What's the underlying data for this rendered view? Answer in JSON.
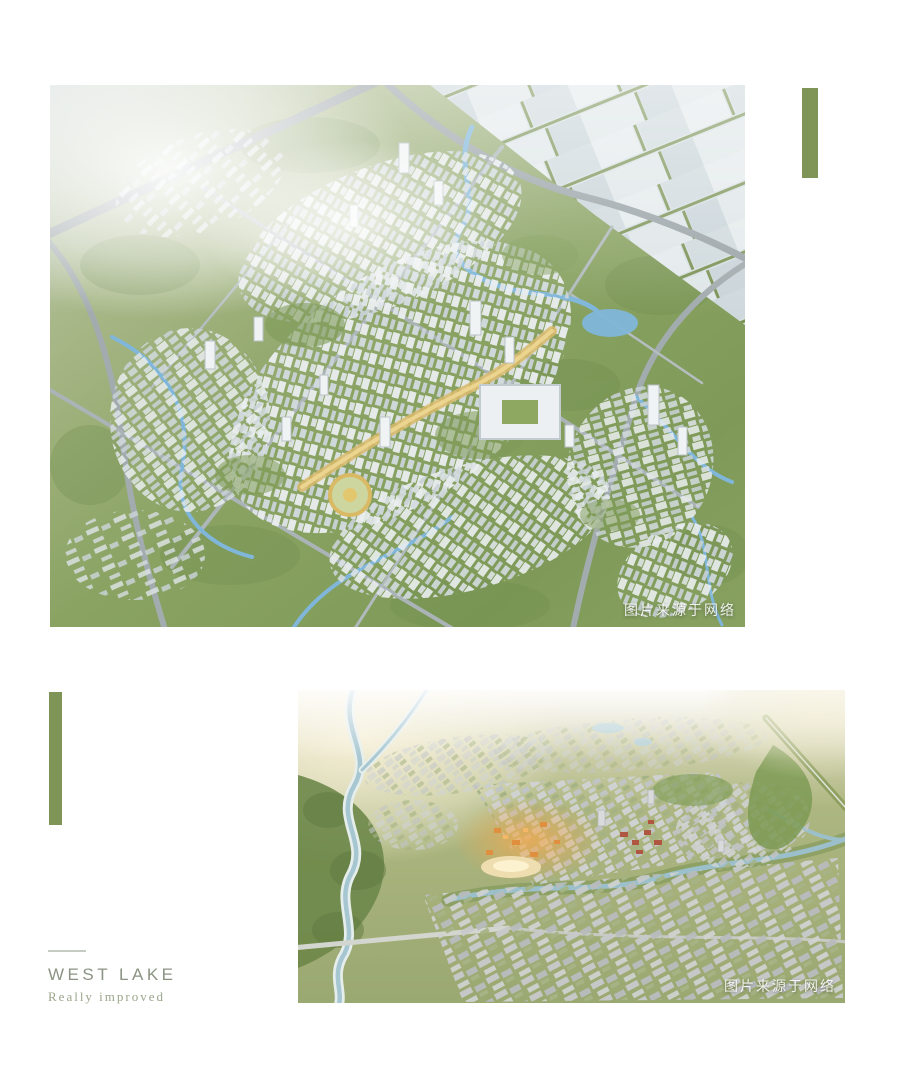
{
  "theme": {
    "background": "#ffffff",
    "accent_green": "#7f9457",
    "caption_title_color": "#8b9383",
    "caption_subtitle_color": "#9ba68c",
    "watermark_color": "#ffffff"
  },
  "hero_image": {
    "watermark": "图片来源于网络"
  },
  "second_image": {
    "watermark": "图片来源于网络"
  },
  "caption": {
    "title": "WEST LAKE",
    "subtitle": "Really improved"
  }
}
